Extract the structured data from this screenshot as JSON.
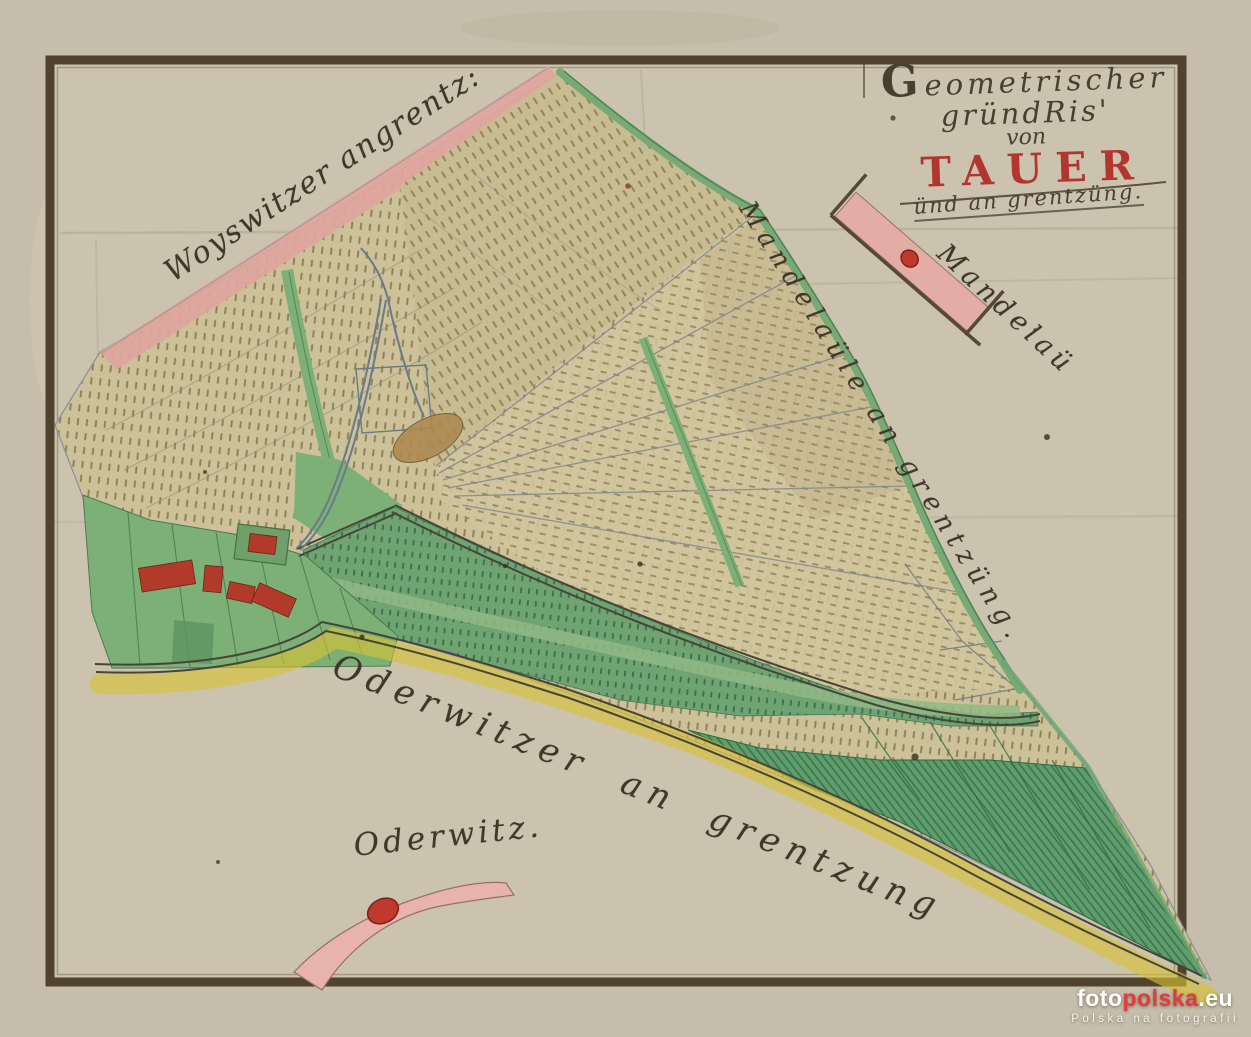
{
  "map": {
    "title": {
      "initial": "G",
      "line1_rest": "eometrischer",
      "line2": "gründRis'",
      "line3": "von",
      "place_name": "TAUER",
      "line5": "ünd an grentzüng."
    },
    "border_labels": {
      "northwest": "Woyswitzer angrentz:",
      "east": "Mandelaüle an grentzüng.",
      "south": "Oderwitzer an grentzung"
    },
    "village_labels": {
      "mandelau": "Mandelaü",
      "oderwitz": "Oderwitz."
    }
  },
  "watermark": {
    "part_white": "foto",
    "part_red": "polska",
    "part_suffix": ".eu",
    "tagline": "Polska na fotografii"
  },
  "colors": {
    "paper": "#c6beaa",
    "paper_inner": "#cbc3ae",
    "frame_brown": "#51422d",
    "field_tan": "#ccc198",
    "meadow_green": "#6fa372",
    "border_green": "#79aa76",
    "village_green": "#7db077",
    "boundary_pink": "#dfa59e",
    "marker_red": "#bf392c",
    "building_red": "#b13a2b",
    "title_red": "#b23530",
    "ink": "#3f382a",
    "yellow_band": "#d9c133",
    "stream_blue": "#697a88",
    "watermark_red": "#e23b3b"
  }
}
